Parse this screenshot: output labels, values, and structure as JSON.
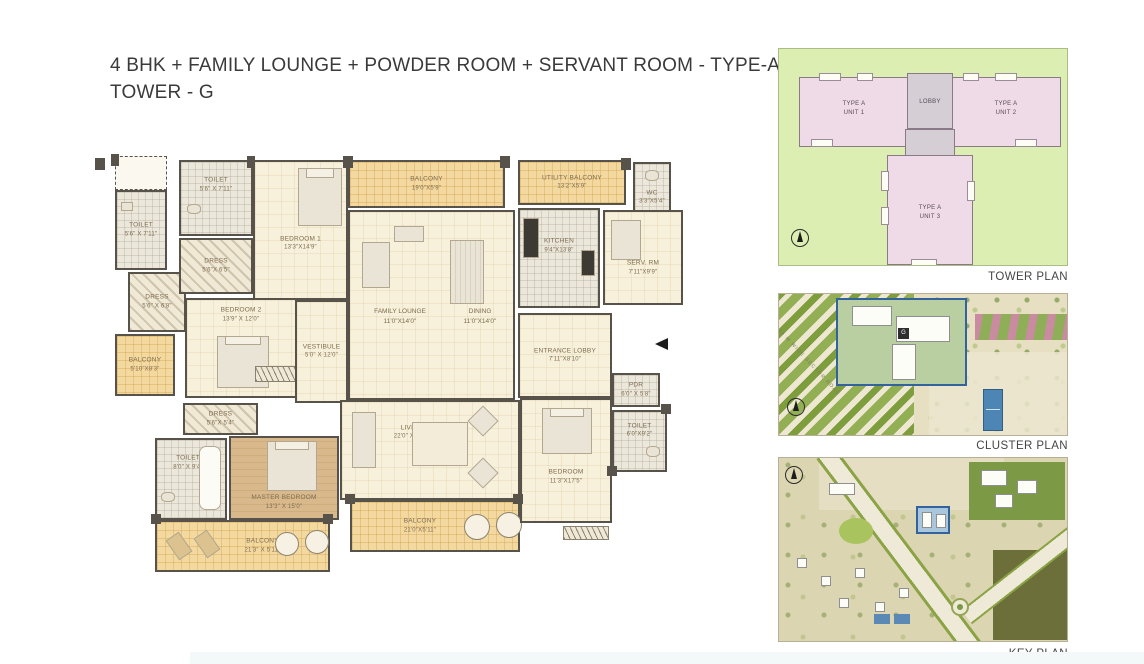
{
  "title": {
    "line1": "4 BHK + FAMILY LOUNGE + POWDER ROOM + SERVANT ROOM - TYPE-A",
    "line2": "TOWER - G"
  },
  "floorplan": {
    "rooms": [
      {
        "id": "toilet-1",
        "name": "TOILET",
        "dims": "5'6\" X 7'11\""
      },
      {
        "id": "toilet-2",
        "name": "TOILET",
        "dims": "5'6\" X 7'11\""
      },
      {
        "id": "dress-1",
        "name": "DRESS",
        "dims": "5'6\"X 6'5\""
      },
      {
        "id": "bedroom-1",
        "name": "BEDROOM 1",
        "dims": "13'3\"X14'9\""
      },
      {
        "id": "dress-2",
        "name": "DRESS",
        "dims": "5'6\" X 6'8\""
      },
      {
        "id": "bedroom-2",
        "name": "BEDROOM 2",
        "dims": "13'9\" X 12'0\""
      },
      {
        "id": "balcony-1",
        "name": "BALCONY",
        "dims": "5'10\"X8'3\""
      },
      {
        "id": "vestibule",
        "name": "VESTIBULE",
        "dims": "5'0\" X 12'0\""
      },
      {
        "id": "family-lounge",
        "name": "FAMILY LOUNGE",
        "dims": "11'0\"X14'0\""
      },
      {
        "id": "dining",
        "name": "DINING",
        "dims": "11'0\"X14'0\""
      },
      {
        "id": "balcony-top",
        "name": "BALCONY",
        "dims": "19'0\"X5'9\""
      },
      {
        "id": "utility-balcony",
        "name": "UTILITY BALCONY",
        "dims": "13'2\"X5'9\""
      },
      {
        "id": "kitchen",
        "name": "KITCHEN",
        "dims": "9'4\"X13'8\""
      },
      {
        "id": "wc",
        "name": "WC",
        "dims": "3'3\"X5'4\""
      },
      {
        "id": "serv-rm",
        "name": "SERV. RM",
        "dims": "7'11\"X9'9\""
      },
      {
        "id": "entrance-lobby",
        "name": "ENTRANCE LOBBY",
        "dims": "7'11\"X8'10\""
      },
      {
        "id": "dress-3",
        "name": "DRESS",
        "dims": "5'6\"X 5'4\""
      },
      {
        "id": "toilet-3",
        "name": "TOILET",
        "dims": "8'0\" X 9'4\""
      },
      {
        "id": "master-bedroom",
        "name": "MASTER BEDROOM",
        "dims": "13'3\" X 15'0\""
      },
      {
        "id": "balcony-2",
        "name": "BALCONY",
        "dims": "21'3\" X 5'11\""
      },
      {
        "id": "living",
        "name": "LIVING",
        "dims": "22'0\" X 20'5\""
      },
      {
        "id": "balcony-3",
        "name": "BALCONY",
        "dims": "21'0\"X5'11\""
      },
      {
        "id": "bedroom-3",
        "name": "BEDROOM",
        "dims": "11'3\"X17'5\""
      },
      {
        "id": "pdr",
        "name": "PDR",
        "dims": "6'0\" X 5'8\""
      },
      {
        "id": "toilet-4",
        "name": "TOILET",
        "dims": "6'0\"X9'2\""
      }
    ]
  },
  "tower_plan": {
    "caption": "TOWER PLAN",
    "lobby_label": "LOBBY",
    "units": [
      {
        "line1": "TYPE A",
        "line2": "UNIT 1"
      },
      {
        "line1": "TYPE A",
        "line2": "UNIT 2"
      },
      {
        "line1": "TYPE A",
        "line2": "UNIT 3"
      }
    ]
  },
  "cluster_plan": {
    "caption": "CLUSTER PLAN",
    "road_label": "24 M WIDE SECTOR ROAD",
    "tower_label": "G"
  },
  "key_plan": {
    "caption": "KEY PLAN"
  },
  "colors": {
    "wall": "#57524a",
    "balcony_floor": "#f3d8a0",
    "tower_unit_fill": "#efdbe7",
    "tower_ground": "#ddeeb2",
    "highlight_blue": "#33639c"
  }
}
